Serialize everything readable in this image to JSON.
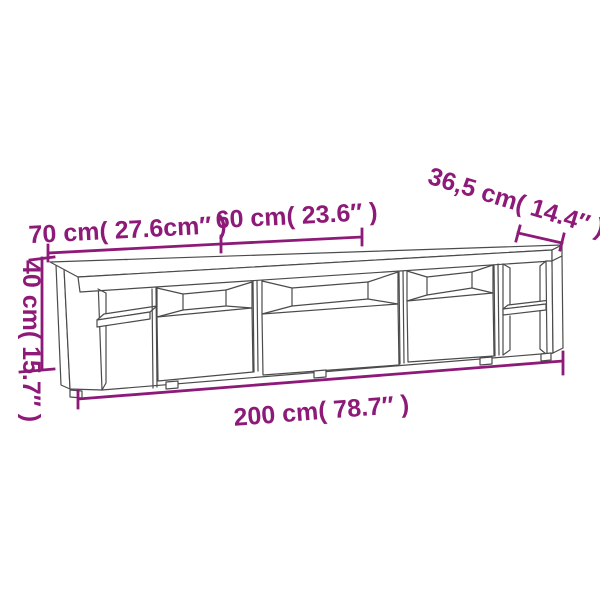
{
  "colors": {
    "dimension": "#8d1a78",
    "outline": "#4b4b4b",
    "background": "#ffffff"
  },
  "diagram": {
    "subject": "TV stand dimension drawing",
    "labels": {
      "section_left_width": "70 cm( 27.6cm″ )",
      "section_middle_width": "60 cm( 23.6″ )",
      "depth": "36,5 cm( 14.4″ )",
      "height": "40 cm( 15.7″ )",
      "total_width": "200 cm( 78.7″ )"
    }
  }
}
